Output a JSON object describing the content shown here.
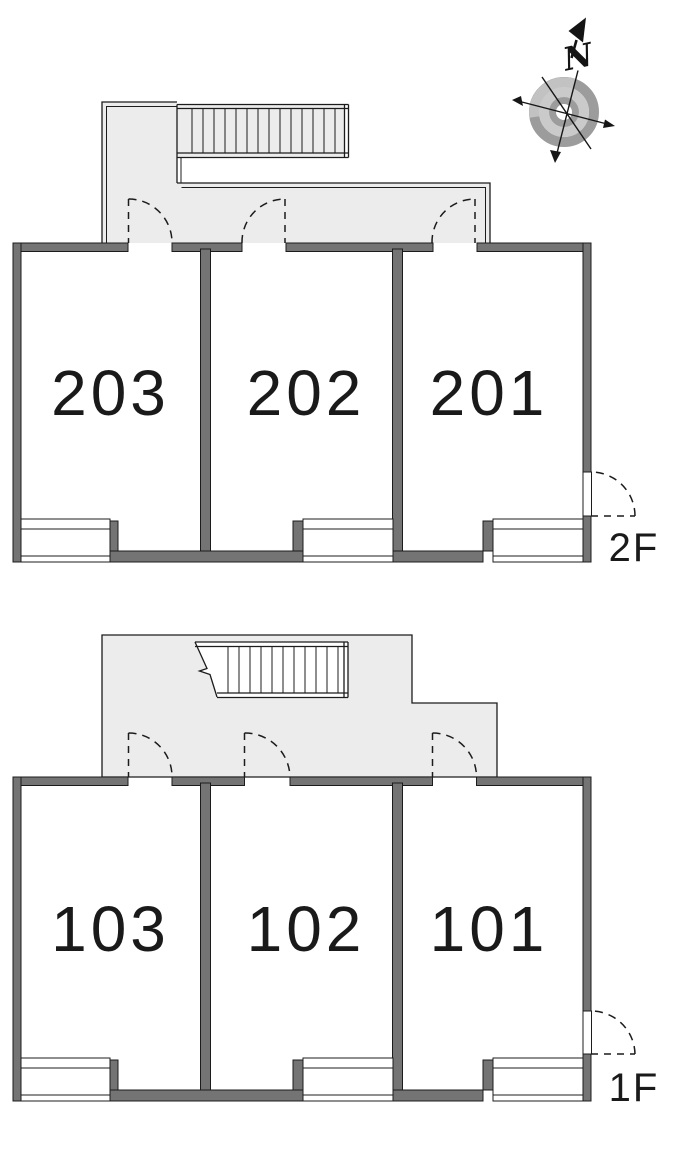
{
  "compass": {
    "north_label": "N"
  },
  "floors": [
    {
      "label": "2F",
      "rooms": [
        {
          "number": "203"
        },
        {
          "number": "202"
        },
        {
          "number": "201"
        }
      ]
    },
    {
      "label": "1F",
      "rooms": [
        {
          "number": "103"
        },
        {
          "number": "102"
        },
        {
          "number": "101"
        }
      ]
    }
  ],
  "colors": {
    "wall_fill": "#747474",
    "outline": "#1c1c1c",
    "balcony_fill": "#ececec",
    "text_color": "#1a1a1a",
    "ring_dark": "#9c9c9c",
    "ring_light": "#cacaca",
    "ring_highlight": "#c2c2c2"
  }
}
